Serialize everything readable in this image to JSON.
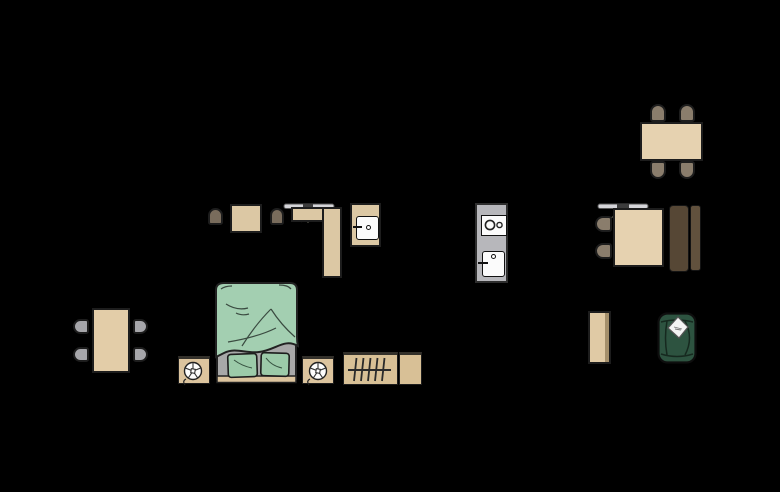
{
  "scene": {
    "description": "Top-down furniture floor-plan layout on a black canvas, no text labels",
    "background": "#000000",
    "palette": {
      "wood": "#e4cfab",
      "wood_dark": "#d9c29b",
      "chair_brown": "#8a7d6c",
      "chair_dark_brown": "#796c5c",
      "chair_gray": "#a6a6aa",
      "appliance_gray": "#b7b7bb",
      "lamp_gray": "#d5d5d9",
      "blanket_green": "#a3cfb1",
      "pillow_green": "#9ccaa9",
      "mattress_gray": "#a8a8a8",
      "armchair_green": "#2d5340",
      "wardrobe_brown": "#564735",
      "wardrobe_brown_light": "#61513d",
      "white": "#f7f7f7",
      "outline": "#1d1d1d"
    },
    "groups": {
      "desk_area": {
        "items": [
          "chair",
          "square side table",
          "chair",
          "ceiling lamp",
          "L-shaped desk",
          "cabinet with white door"
        ]
      },
      "kitchen": {
        "items": [
          "stove with two burners and oven door"
        ]
      },
      "dining_top_right": {
        "items": [
          "dining table",
          "four brown chairs"
        ]
      },
      "table_right": {
        "items": [
          "ceiling lamp",
          "square table",
          "two brown chairs",
          "two-part dark wardrobe"
        ]
      },
      "dining_left": {
        "items": [
          "dining table",
          "four gray chairs"
        ]
      },
      "bedroom": {
        "items": [
          "nightstand with table fan",
          "double bed with green duvet and two pillows",
          "nightstand with table fan",
          "radiator with hatching",
          "small side cube"
        ]
      },
      "living_right": {
        "items": [
          "shelf sideboard",
          "green armchair with white pillow"
        ]
      }
    }
  }
}
